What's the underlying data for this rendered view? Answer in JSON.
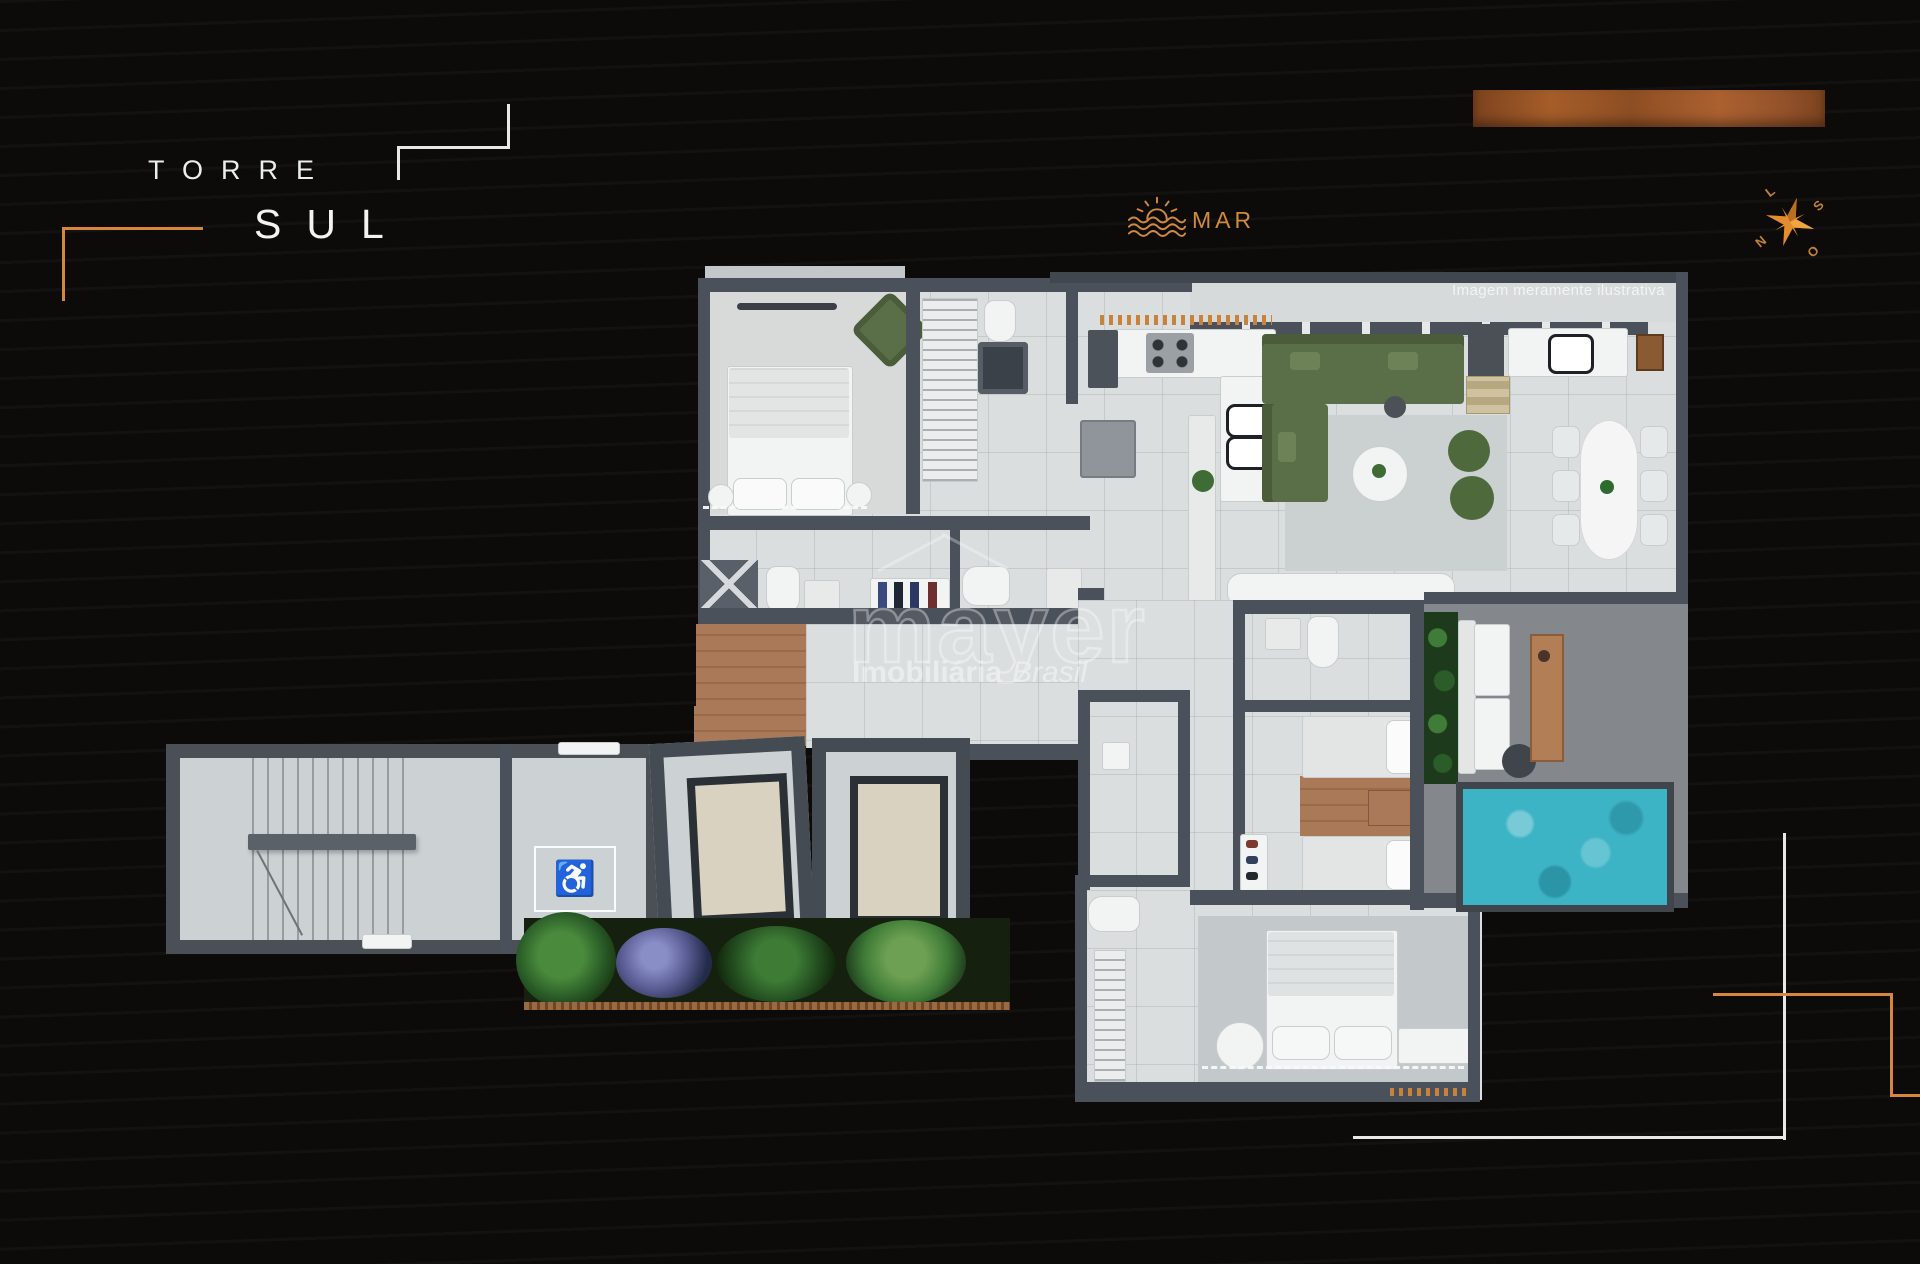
{
  "title": {
    "line1": "TORRE",
    "line2": "SUL"
  },
  "mar": {
    "label": "MAR"
  },
  "compass": {
    "n": "N",
    "s": "S",
    "l": "L",
    "o": "O"
  },
  "plan": {
    "disclaimer": "Imagem meramente ilustrativa"
  },
  "watermark": {
    "brand": "mayer",
    "line2_bold": "Imobiliária",
    "line2_italic": "Brasil"
  },
  "accessibility_icon": "♿",
  "palette": {
    "accent_orange": "#D9863B",
    "compass_orange": "#E38D2E",
    "wall_gray": "#4B515A",
    "floor_gray": "#DADEDF",
    "pool_teal": "#3CB4C5",
    "sofa_green": "#5A6F47",
    "wood_brown": "#AA7A58",
    "background": "#0C0B0A"
  }
}
